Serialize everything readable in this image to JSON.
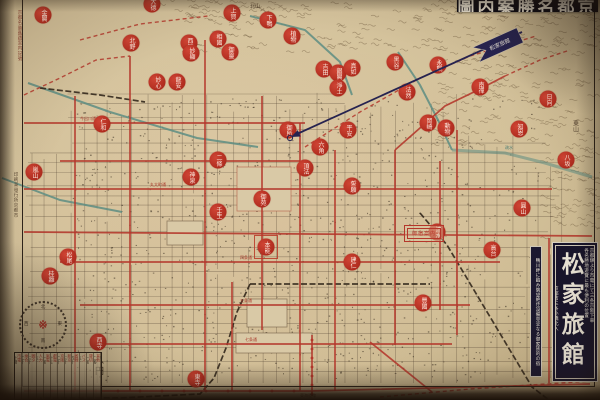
{
  "colors": {
    "paper": "#d3c19a",
    "street_ink": "#4a3b2c",
    "tram_red": "#b4372b",
    "seal_red": "#bf3527",
    "river_teal": "#5d8d82",
    "rail_black": "#33281c",
    "navy": "#262350",
    "ad_bg": "#17142b"
  },
  "title_strip": {
    "text": "圖内案勝名都京"
  },
  "arrow": {
    "flag_label": "松家旅館",
    "tip": [
      291,
      137
    ],
    "tail": [
      522,
      32
    ]
  },
  "ad_box": {
    "name_vertical": "松家旅館",
    "right_col_1": "京都驛より市電にて三条京阪下車",
    "right_col_2": "各名勝地遊覽に最も便利の位置",
    "left_col_1": "京都市三条小橋北入",
    "left_col_2": "電話上三〇七六番",
    "outer_col": "鴨川畔に臨み眺望絶佳設備完全なる御家族的の宿"
  },
  "red_box_stamp": {
    "label": "御宿案内"
  },
  "margin": {
    "left_top": "京都名勝舊蹟案内記號",
    "left_mid": "印刷兼發行所京都市",
    "price": "八円"
  },
  "compass": {
    "n": "北",
    "e": "東",
    "s": "南",
    "w": "西",
    "center": "※"
  },
  "legend_table": {
    "cols": [
      "市電",
      "乘合",
      "圓タ",
      "人力",
      "嵐電",
      "叡電",
      "京阪",
      "新京",
      "省線",
      "バス",
      "貸切",
      "其他"
    ],
    "fares": [
      "十錢",
      "二十",
      "三十",
      "五十",
      "一圓",
      "十五",
      "二十",
      "三十",
      "四十",
      "五十",
      "一圓",
      "二圓"
    ]
  },
  "map_labels": [
    {
      "x": 150,
      "y": 186,
      "t": "丸太町通",
      "c": "#a8382a",
      "s": 4
    },
    {
      "x": 240,
      "y": 259,
      "t": "四条通",
      "c": "#a8382a",
      "s": 4
    },
    {
      "x": 240,
      "y": 302,
      "t": "五条通",
      "c": "#a8382a",
      "s": 4
    },
    {
      "x": 245,
      "y": 341,
      "t": "七条通",
      "c": "#a8382a",
      "s": 4
    },
    {
      "x": 80,
      "y": 120,
      "t": "今出川通",
      "c": "#a8382a",
      "s": 4
    },
    {
      "x": 505,
      "y": 149,
      "t": "疏水",
      "c": "#4e7d74",
      "s": 4
    },
    {
      "x": 575,
      "y": 120,
      "t": "東山",
      "c": "#53412f",
      "s": 6,
      "v": 1
    },
    {
      "x": 250,
      "y": 8,
      "t": "北山",
      "c": "#53412f",
      "s": 5
    },
    {
      "x": 300,
      "y": 397,
      "t": "東海道線",
      "c": "#53412f",
      "s": 4
    }
  ],
  "seals": [
    [
      43,
      15,
      "金閣"
    ],
    [
      152,
      4,
      "大德"
    ],
    [
      232,
      13,
      "上賀"
    ],
    [
      268,
      20,
      "下鴨"
    ],
    [
      131,
      43,
      "北野"
    ],
    [
      189,
      43,
      "西陣"
    ],
    [
      218,
      39,
      "相國"
    ],
    [
      230,
      52,
      "御靈"
    ],
    [
      292,
      36,
      "植物"
    ],
    [
      324,
      69,
      "吉田"
    ],
    [
      338,
      73,
      "銀閣"
    ],
    [
      352,
      68,
      "真如"
    ],
    [
      395,
      62,
      "黑谷"
    ],
    [
      438,
      65,
      "永觀"
    ],
    [
      480,
      87,
      "南禪"
    ],
    [
      548,
      99,
      "日向"
    ],
    [
      191,
      53,
      "妙顯"
    ],
    [
      157,
      82,
      "妙心"
    ],
    [
      177,
      82,
      "龍安"
    ],
    [
      102,
      124,
      "仁和"
    ],
    [
      34,
      172,
      "嵐山"
    ],
    [
      288,
      130,
      "御所"
    ],
    [
      348,
      130,
      "平安"
    ],
    [
      428,
      123,
      "岡崎"
    ],
    [
      446,
      128,
      "動物"
    ],
    [
      519,
      129,
      "知恩"
    ],
    [
      566,
      160,
      "八坂"
    ],
    [
      218,
      160,
      "二條"
    ],
    [
      191,
      177,
      "神泉"
    ],
    [
      218,
      212,
      "壬生"
    ],
    [
      266,
      247,
      "本能",
      1
    ],
    [
      262,
      199,
      "御苑"
    ],
    [
      305,
      168,
      "頂法"
    ],
    [
      352,
      186,
      "誓願"
    ],
    [
      68,
      257,
      "松尾"
    ],
    [
      50,
      276,
      "桂離"
    ],
    [
      98,
      342,
      "西寺"
    ],
    [
      196,
      379,
      "東寺"
    ],
    [
      423,
      303,
      "豐國"
    ],
    [
      352,
      262,
      "建仁"
    ],
    [
      437,
      232,
      "清水"
    ],
    [
      492,
      250,
      "高台"
    ],
    [
      522,
      208,
      "圓山"
    ],
    [
      320,
      147,
      "六角"
    ],
    [
      407,
      92,
      "法然"
    ],
    [
      338,
      88,
      "淨土"
    ]
  ],
  "map_lines": {
    "rivers": [
      [
        [
          28,
          83
        ],
        [
          110,
          112
        ],
        [
          197,
          138
        ],
        [
          258,
          147
        ]
      ],
      [
        [
          2,
          178
        ],
        [
          60,
          200
        ],
        [
          122,
          212
        ]
      ],
      [
        [
          250,
          16
        ],
        [
          305,
          30
        ],
        [
          340,
          62
        ],
        [
          352,
          95
        ]
      ],
      [
        [
          398,
          52
        ],
        [
          420,
          85
        ],
        [
          438,
          120
        ],
        [
          452,
          150
        ]
      ],
      [
        [
          452,
          150
        ],
        [
          505,
          153
        ],
        [
          545,
          163
        ],
        [
          592,
          177
        ]
      ]
    ],
    "rails": [
      [
        [
          420,
          213
        ],
        [
          447,
          245
        ],
        [
          532,
          387
        ],
        [
          549,
          400
        ]
      ],
      [
        [
          250,
          284
        ],
        [
          430,
          284
        ]
      ],
      [
        [
          250,
          284
        ],
        [
          237,
          312
        ],
        [
          226,
          348
        ],
        [
          214,
          378
        ],
        [
          200,
          394
        ],
        [
          120,
          398
        ],
        [
          40,
          398
        ]
      ],
      [
        [
          40,
          88
        ],
        [
          100,
          95
        ],
        [
          145,
          102
        ]
      ]
    ],
    "tram": [
      [
        [
          24,
          123
        ],
        [
          305,
          123
        ]
      ],
      [
        [
          60,
          161
        ],
        [
          300,
          161
        ]
      ],
      [
        [
          24,
          189
        ],
        [
          552,
          189
        ]
      ],
      [
        [
          24,
          232
        ],
        [
          592,
          236
        ]
      ],
      [
        [
          60,
          262
        ],
        [
          500,
          262
        ]
      ],
      [
        [
          80,
          305
        ],
        [
          470,
          305
        ]
      ],
      [
        [
          100,
          344
        ],
        [
          452,
          344
        ]
      ],
      [
        [
          24,
          391
        ],
        [
          310,
          391
        ],
        [
          590,
          384
        ]
      ],
      [
        [
          75,
          96
        ],
        [
          75,
          391
        ]
      ],
      [
        [
          130,
          56
        ],
        [
          130,
          391
        ]
      ],
      [
        [
          205,
          40
        ],
        [
          205,
          391
        ]
      ],
      [
        [
          232,
          282
        ],
        [
          232,
          391
        ]
      ],
      [
        [
          262,
          96
        ],
        [
          262,
          330
        ]
      ],
      [
        [
          300,
          123
        ],
        [
          300,
          391
        ]
      ],
      [
        [
          312,
          335
        ],
        [
          312,
          396
        ]
      ],
      [
        [
          335,
          150
        ],
        [
          335,
          391
        ]
      ],
      [
        [
          395,
          150
        ],
        [
          395,
          345
        ]
      ],
      [
        [
          440,
          161
        ],
        [
          440,
          310
        ]
      ],
      [
        [
          457,
          130
        ],
        [
          457,
          335
        ]
      ],
      [
        [
          549,
          238
        ],
        [
          549,
          383
        ]
      ],
      [
        [
          395,
          150
        ],
        [
          445,
          106
        ],
        [
          478,
          90
        ],
        [
          505,
          76
        ]
      ],
      [
        [
          370,
          342
        ],
        [
          432,
          392
        ]
      ]
    ],
    "tram_dashed": [
      [
        [
          80,
          40
        ],
        [
          140,
          24
        ],
        [
          208,
          16
        ]
      ],
      [
        [
          305,
          147
        ],
        [
          360,
          112
        ],
        [
          420,
          78
        ],
        [
          470,
          56
        ],
        [
          536,
          36
        ]
      ],
      [
        [
          380,
          397
        ],
        [
          470,
          389
        ],
        [
          592,
          381
        ]
      ],
      [
        [
          24,
          95
        ],
        [
          60,
          78
        ],
        [
          96,
          60
        ],
        [
          130,
          56
        ]
      ],
      [
        [
          505,
          76
        ],
        [
          540,
          60
        ],
        [
          570,
          50
        ]
      ]
    ],
    "patches": [
      {
        "x": 237,
        "y": 167,
        "w": 54,
        "h": 44,
        "rs": "rgba(170,60,42,.55)"
      },
      {
        "x": 167,
        "y": 221,
        "w": 36,
        "h": 24,
        "rs": "rgba(70,52,32,.5)"
      },
      {
        "x": 247,
        "y": 299,
        "w": 40,
        "h": 28,
        "rs": "rgba(70,52,32,.5)"
      },
      {
        "x": 236,
        "y": 333,
        "w": 76,
        "h": 20,
        "rs": "rgba(70,52,32,.5)"
      }
    ]
  }
}
